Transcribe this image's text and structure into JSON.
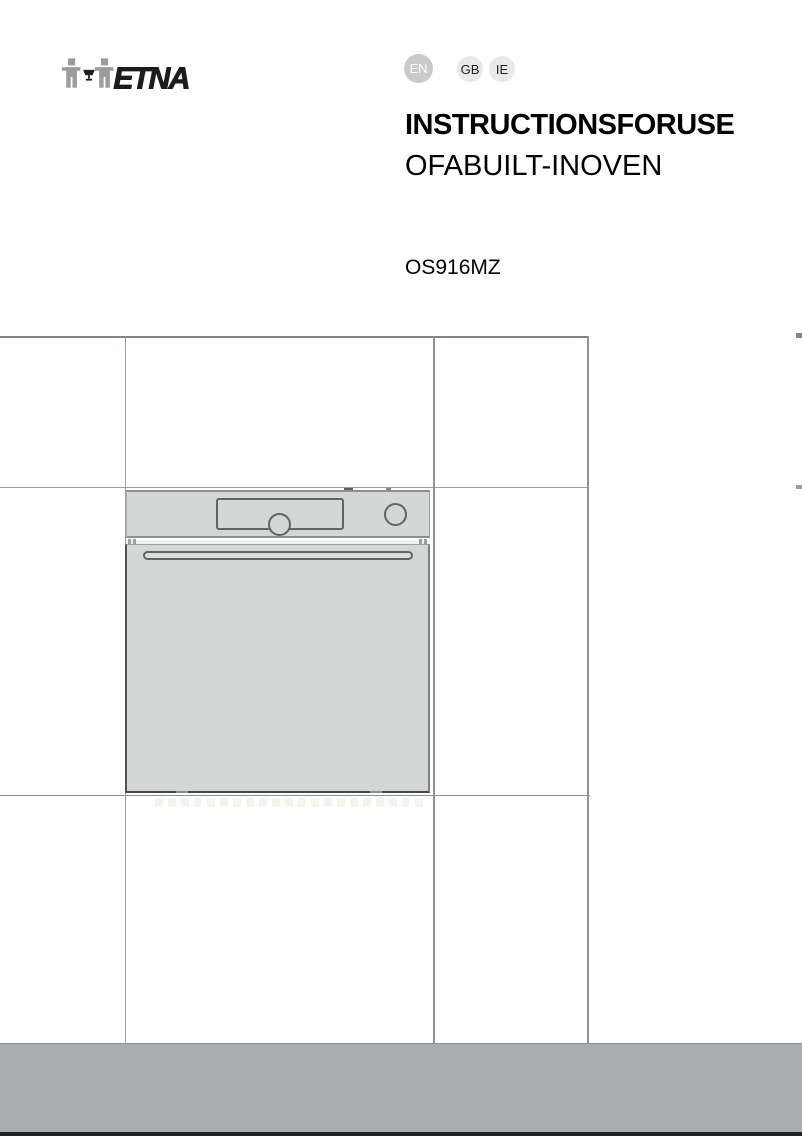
{
  "document": {
    "brand": "ETNA",
    "languages": [
      {
        "code": "EN",
        "active": true
      },
      {
        "code": "GB",
        "active": false
      },
      {
        "code": "IE",
        "active": false
      }
    ],
    "title_line1": "INSTRUCTIONSFORUSE",
    "title_line2": "OFABUILT-INOVEN",
    "model": "OS916MZ"
  },
  "figure": {
    "type": "technical-line-drawing",
    "subject": "Built-in oven mounted in tall kitchen cabinetry, front elevation with control panel, display, two knobs and door handle"
  },
  "colors": {
    "oven_fill": "#d5d7d6",
    "drawing_line": "#8f9395",
    "footer_bar": "#a9adb0",
    "footer_strip": "#1f2227",
    "badge_active_bg": "#c9cac9",
    "badge_active_text": "#ffffff",
    "badge_inactive_bg": "#e9e9e9",
    "badge_inactive_text": "#1f1f1f",
    "logo_gray": "#9c9c9c",
    "logo_black": "#1c1c1c"
  }
}
